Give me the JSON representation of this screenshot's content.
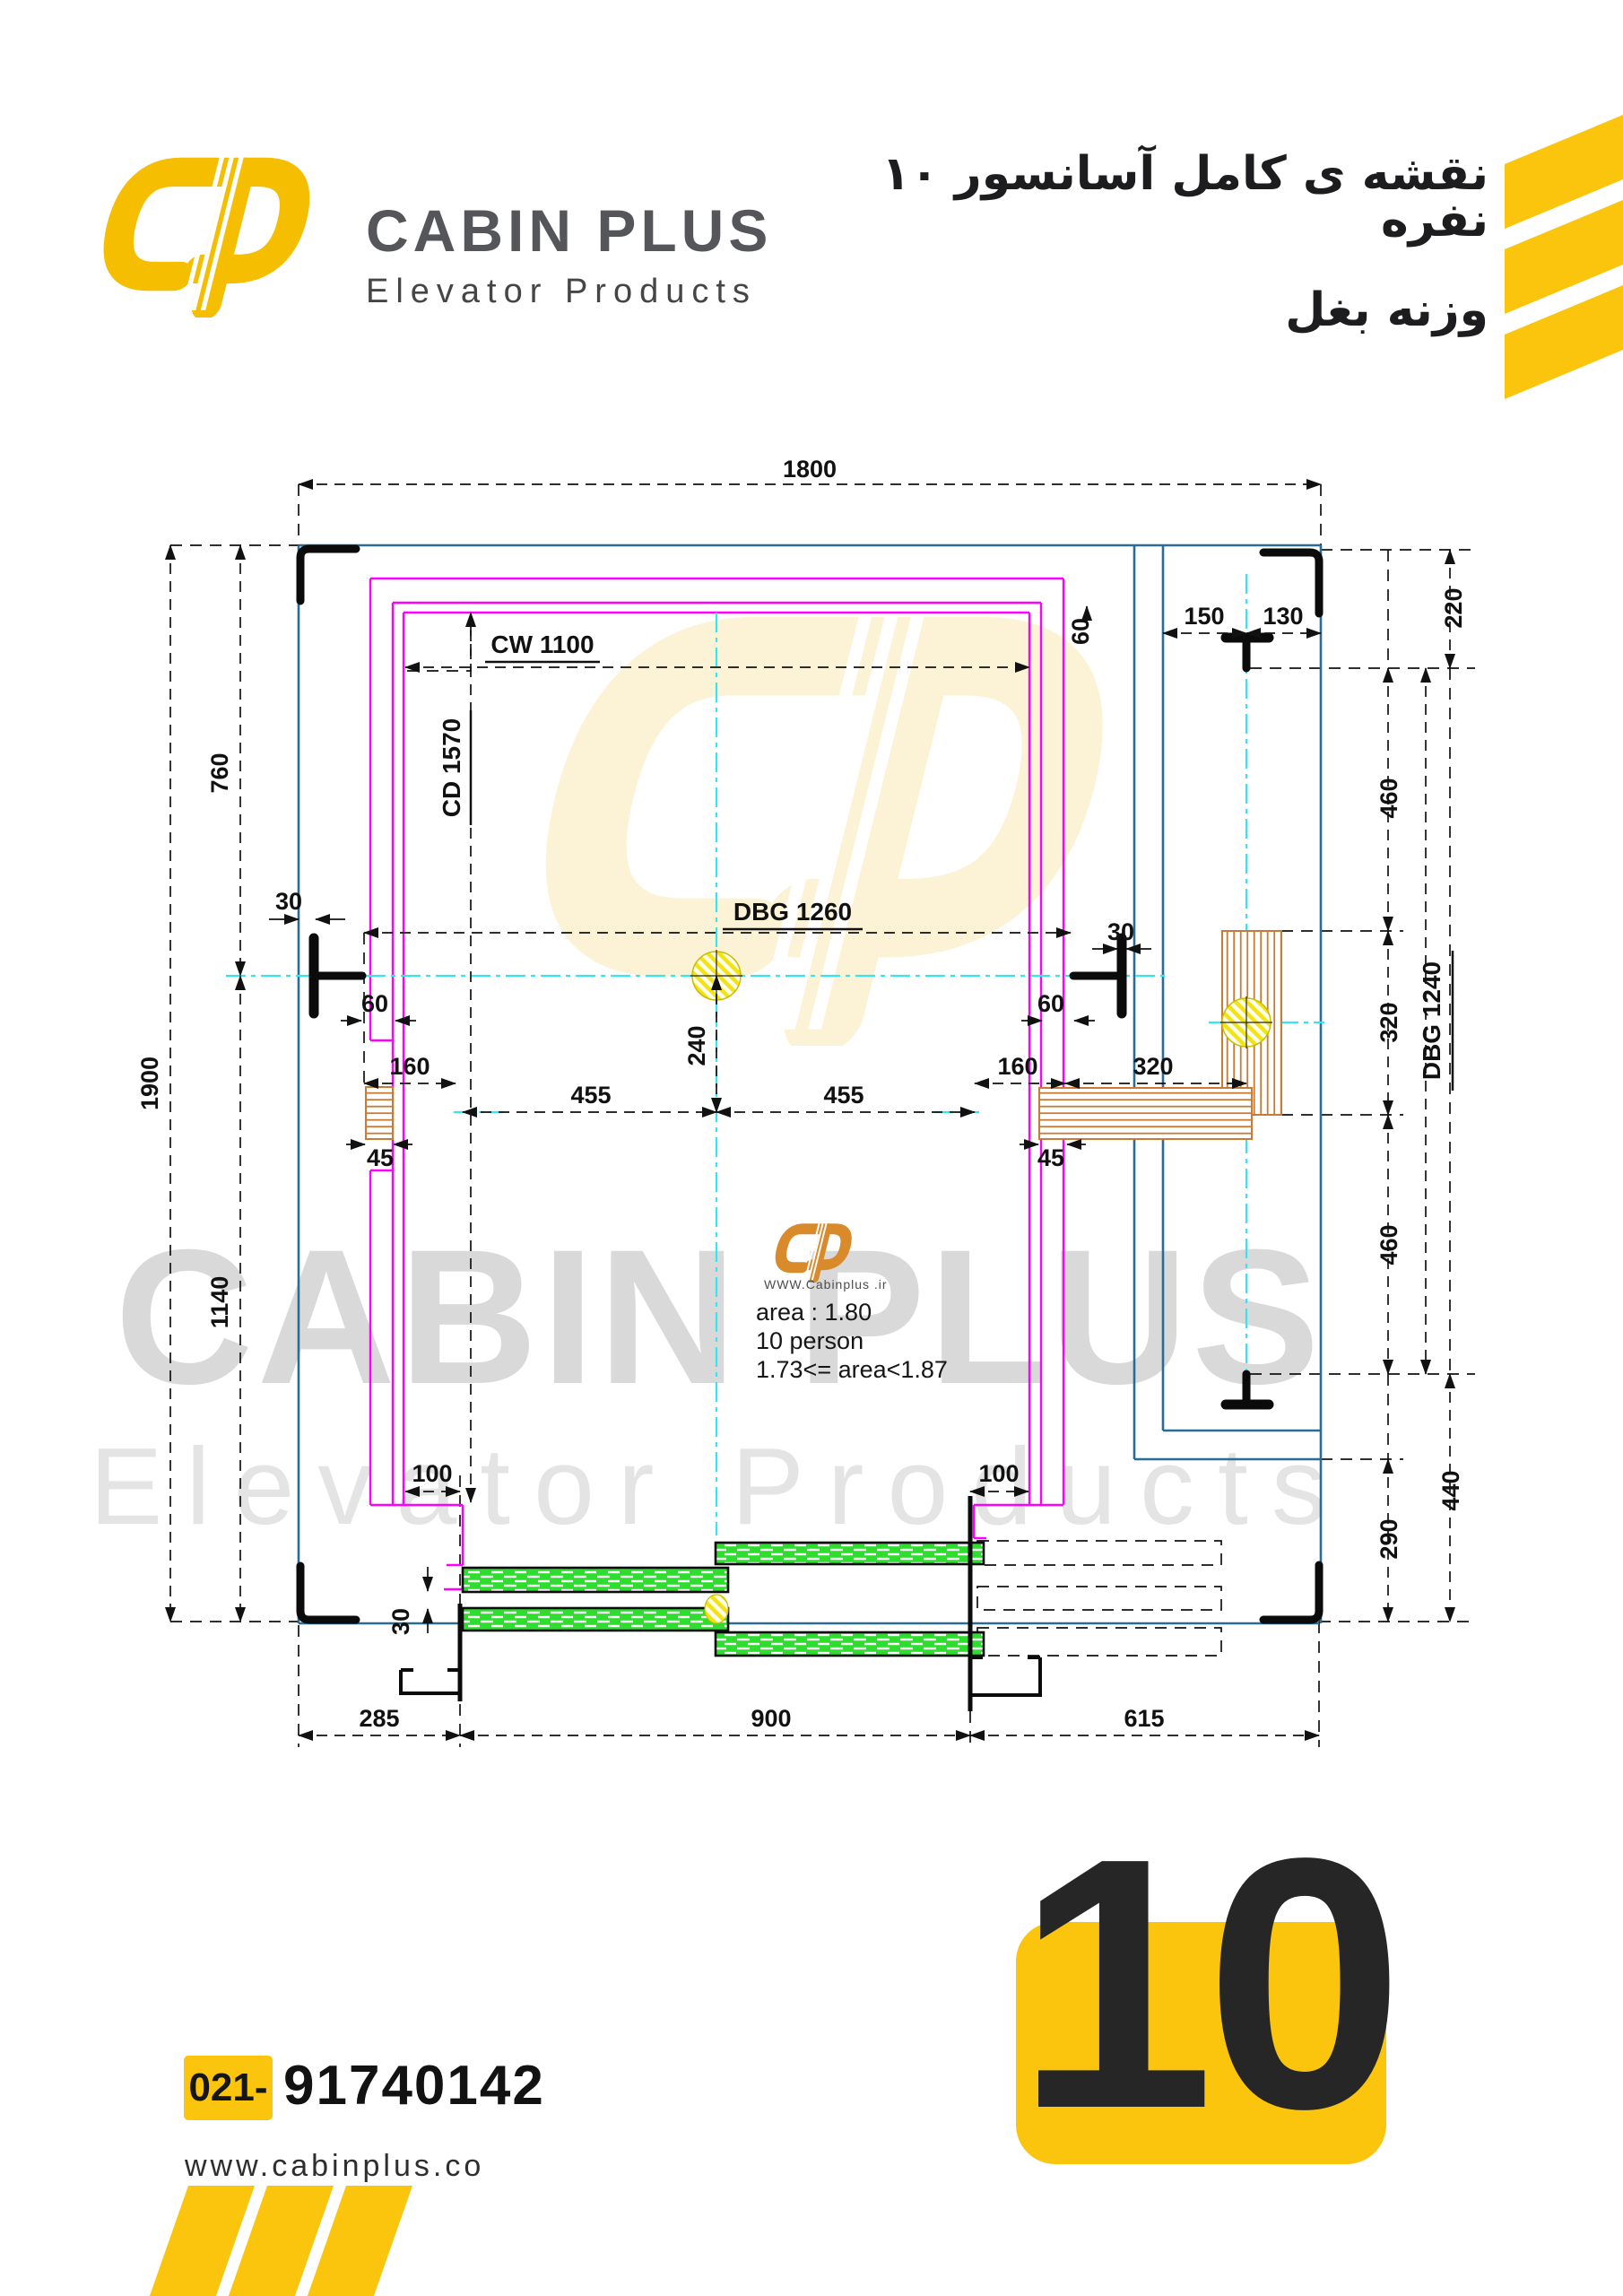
{
  "header": {
    "brand": "CABIN PLUS",
    "subtitle": "Elevator Products",
    "title_fa_line1": "نقشه ی کامل آسانسور ۱۰ نفره",
    "title_fa_line2": "وزنه بغل"
  },
  "watermark": {
    "row1": "CABIN PLUS",
    "row2": "Elevator Products",
    "site": "WWW.Cabinplus .ir"
  },
  "cabin_info": {
    "area": "area : 1.80",
    "persons": "10 person",
    "range": "1.73<= area<1.87"
  },
  "labels": {
    "cw": "CW 1100",
    "cd": "CD 1570",
    "dbg_car": "DBG 1260",
    "dbg_cwt": "DBG 1240"
  },
  "dims": {
    "d1800": "1800",
    "d1900": "1900",
    "d760": "760",
    "d1140": "1140",
    "d285": "285",
    "d900": "900",
    "d615": "615",
    "d150": "150",
    "d130": "130",
    "d220": "220",
    "d460a": "460",
    "d320v": "320",
    "d460b": "460",
    "d440": "440",
    "d290": "290",
    "d30l": "30",
    "d30r": "30",
    "d30door": "30",
    "d60l": "60",
    "d60r": "60",
    "d60t": "60",
    "d160l": "160",
    "d160r": "160",
    "d320h": "320",
    "d455a": "455",
    "d455b": "455",
    "d240": "240",
    "d45l": "45",
    "d45r": "45",
    "d100l": "100",
    "d100r": "100"
  },
  "footer": {
    "phone_code": "021-",
    "phone": "91740142",
    "website": "www.cabinplus.co",
    "badge": "10"
  },
  "colors": {
    "brand_yellow": "#FBC40D",
    "cad_blue": "#2A6C94",
    "cad_magenta": "#FF00FF",
    "cad_cyan": "#35E6F0",
    "cad_green": "#2FDD2F",
    "cad_orange": "#C97B36",
    "watermark_gray": "#D9D9D9"
  }
}
